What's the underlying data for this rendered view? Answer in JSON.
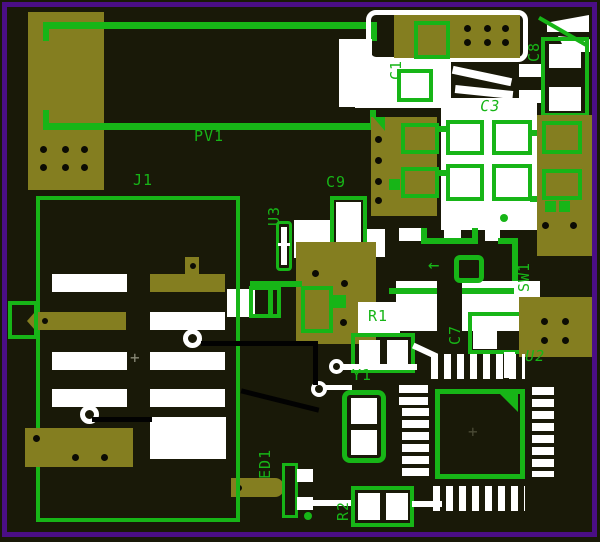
{
  "labels": {
    "pv1": "PV1",
    "j1": "J1",
    "c1": "C1",
    "c8": "C8",
    "c3": "C3",
    "c9": "C9",
    "u3": "U3",
    "sw1": "SW1",
    "r1": "R1",
    "c7": "C7",
    "u2": "U2",
    "y1": "Y1",
    "led1": "LED1",
    "r2": "R2"
  },
  "markers": {
    "plus": "+",
    "arrow": "←"
  },
  "colors": {
    "board_background": "#191908",
    "window_border": "#4b0e86",
    "copper_pour": "#847e20",
    "silkscreen": "#17b517",
    "pad": "#ffffff",
    "drill": "#0c0c04"
  }
}
